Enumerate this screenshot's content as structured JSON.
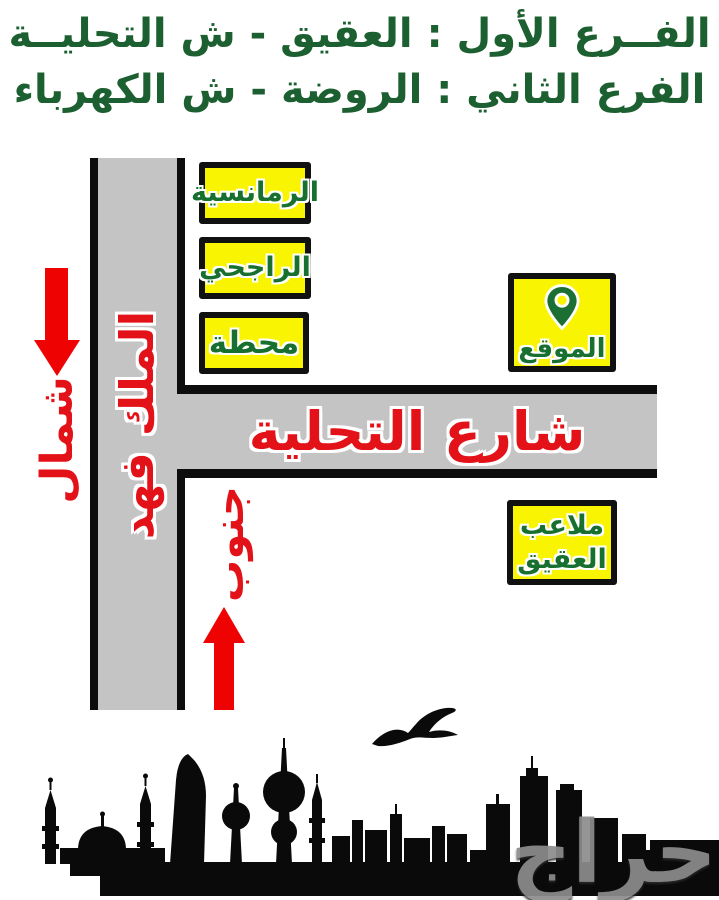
{
  "header": {
    "line1": "الفــرع الأول : العقيق - ش التحليــة",
    "line2": "الفرع الثاني : الروضة - ش الكهرباء"
  },
  "map": {
    "roads": {
      "king_fahd": {
        "label": "الملك فهد"
      },
      "tahlia": {
        "label": "شارع التحلية"
      }
    },
    "landmarks": {
      "romansiah": {
        "label": "الرمانسية"
      },
      "rajhi": {
        "label": "الراجحي"
      },
      "station": {
        "label": "محطة"
      },
      "site": {
        "label": "الموقع",
        "icon": "map-pin-icon"
      },
      "aqiq_fields": {
        "line1": "ملاعب",
        "line2": "العقيق"
      }
    },
    "compass": {
      "north": {
        "label": "شمال"
      },
      "south": {
        "label": "جنوب"
      }
    }
  },
  "watermark": {
    "text": "حراج"
  },
  "colors": {
    "header_green": "#1c5f30",
    "label_green": "#17702f",
    "road_text_red": "#e31218",
    "arrow_red": "#ee0202",
    "road_gray": "#c4c4c4",
    "box_yellow": "#f8f402",
    "box_border": "#111111",
    "skyline_black": "#0a0a0a",
    "watermark_gray": "#8d8d8d"
  }
}
